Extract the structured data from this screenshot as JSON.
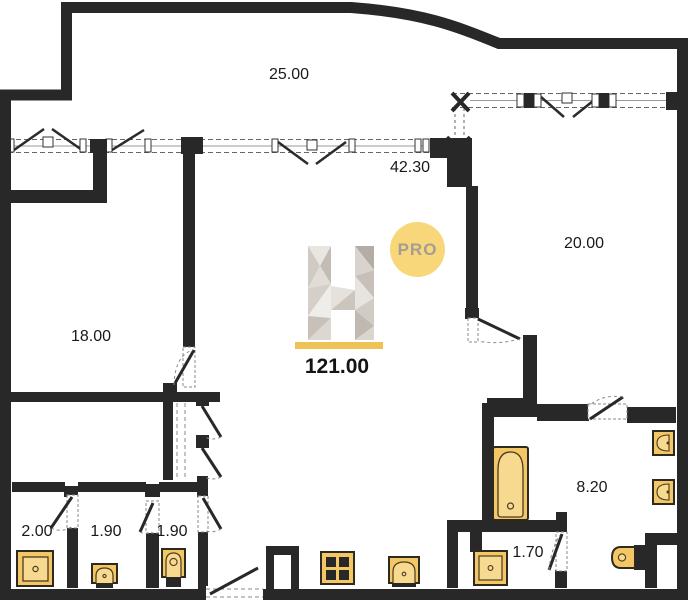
{
  "plan": {
    "title": "apartment floor plan",
    "logo": {
      "letter": "H",
      "badge": "PRO"
    },
    "total_area": "121.00",
    "rooms": [
      {
        "id": "terrace",
        "area": "25.00",
        "x": 289,
        "y": 75
      },
      {
        "id": "living-kitchen",
        "area": "42.30",
        "x": 410,
        "y": 168
      },
      {
        "id": "bedroom-right",
        "area": "20.00",
        "x": 584,
        "y": 244
      },
      {
        "id": "bedroom-left",
        "area": "18.00",
        "x": 91,
        "y": 337
      },
      {
        "id": "bathroom",
        "area": "8.20",
        "x": 592,
        "y": 488
      },
      {
        "id": "shower-room",
        "area": "2.00",
        "x": 37,
        "y": 532
      },
      {
        "id": "washroom",
        "area": "1.90",
        "x": 106,
        "y": 532
      },
      {
        "id": "wc",
        "area": "1.90",
        "x": 172,
        "y": 532
      },
      {
        "id": "utility",
        "area": "1.70",
        "x": 528,
        "y": 553
      }
    ],
    "colors": {
      "wall": "#282828",
      "fixture": "#f3c765",
      "fixture_light": "#f7d98f",
      "accent_underline": "#efc255",
      "badge": "#f8d77a"
    }
  }
}
